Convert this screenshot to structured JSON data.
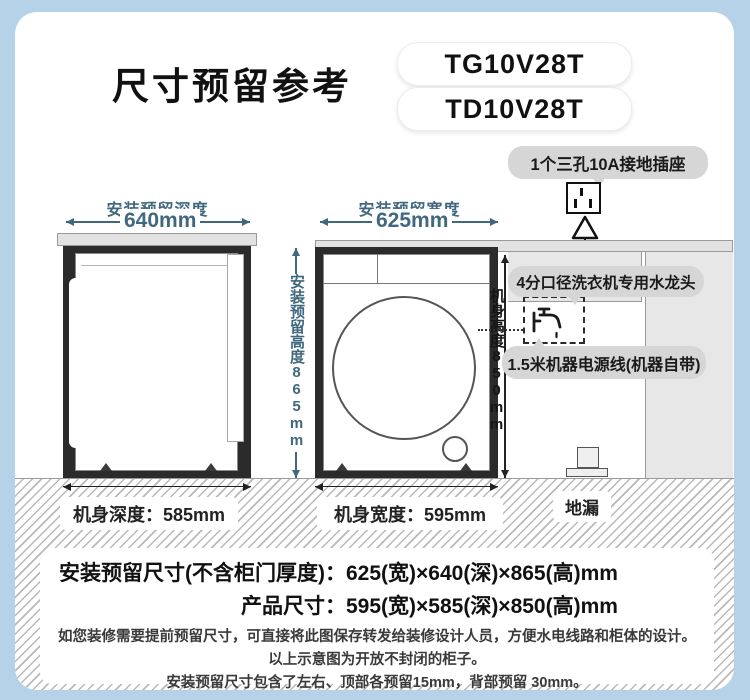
{
  "header": {
    "title": "尺寸预留参考",
    "models": [
      "TG10V28T",
      "TD10V28T"
    ]
  },
  "callouts": {
    "socket": "1个三孔10A接地插座",
    "faucet": "4分口径洗衣机专用水龙头",
    "power": "1.5米机器电源线(机器自带)",
    "drain": "地漏"
  },
  "side_view": {
    "clearance_label": "安装预留深度",
    "clearance_value": "640mm",
    "body_label": "机身深度：585mm"
  },
  "front_view": {
    "clearance_label": "安装预留宽度",
    "clearance_value": "625mm",
    "height_clearance_label": "安装预留高度865mm",
    "body_height_label": "机身高度850mm",
    "body_label": "机身宽度：595mm"
  },
  "summary": {
    "install_label": "安装预留尺寸(不含柜门厚度)：",
    "install_value": "625(宽)×640(深)×865(高)mm",
    "product_label": "产品尺寸：",
    "product_value": "595(宽)×585(深)×850(高)mm"
  },
  "notes": [
    "如您装修需要提前预留尺寸，可直接将此图保存转发给装修设计人员，方便水电线路和柜体的设计。",
    "以上示意图为开放不封闭的柜子。",
    "安装预留尺寸包含了左右、顶部各预留15mm，背部预留 30mm。"
  ],
  "colors": {
    "frame_blue": "#b6d2e8",
    "dim_blue": "#40687e",
    "bubble_gray": "#d6d6d6",
    "cabinet_dark": "#2b2b2b"
  }
}
